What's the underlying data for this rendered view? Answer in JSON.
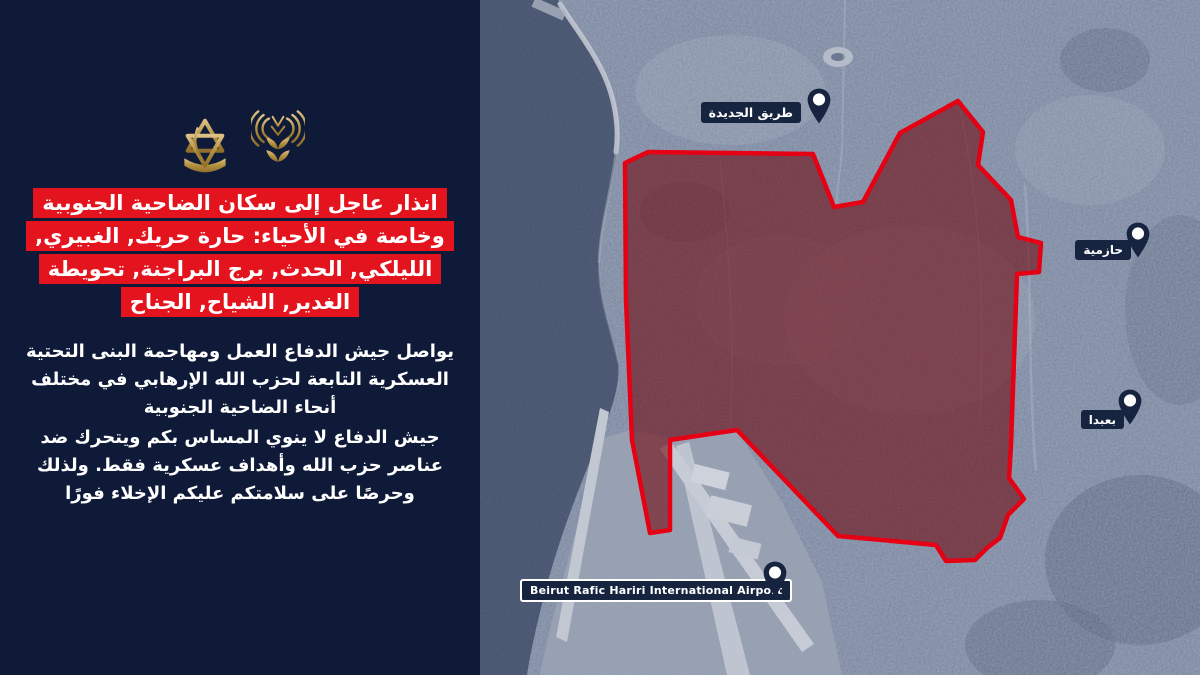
{
  "panel": {
    "background_color": "#0e1a38",
    "accent_red": "#e3141d",
    "gold": "#b4913f",
    "icons": [
      {
        "name": "broadcast-antenna-icon"
      },
      {
        "name": "idf-insignia-icon"
      }
    ],
    "headline_lines": [
      "انذار عاجل إلى سكان الضاحية الجنوبية",
      "وخاصة في الأحياء: حارة حريك, الغبيري,",
      "الليلكي, الحدث, برج البراجنة, تحويطة",
      "الغدير, الشياح, الجناح"
    ],
    "paragraphs": [
      "يواصل جيش الدفاع العمل ومهاجمة البنى التحتية\nالعسكرية التابعة لحزب الله الإرهابي في مختلف\nأنحاء الضاحية الجنوبية",
      "جيش الدفاع لا ينوي المساس بكم ويتحرك ضد\nعناصر حزب الله وأهداف عسكرية فقط. ولذلك\nوحرصًا على سلامتكم عليكم الإخلاء فورًا"
    ]
  },
  "map": {
    "style": "satellite",
    "zone_outline_color": "#e60013",
    "zone_fill_color": "rgba(112,10,16,0.6)",
    "pin_color": "#16243f",
    "pins": [
      {
        "label": "طريق الجديدة"
      },
      {
        "label": "حازمية"
      },
      {
        "label": "بعبدا"
      },
      {
        "label": "Beirut Rafic Hariri International Airport"
      }
    ]
  }
}
